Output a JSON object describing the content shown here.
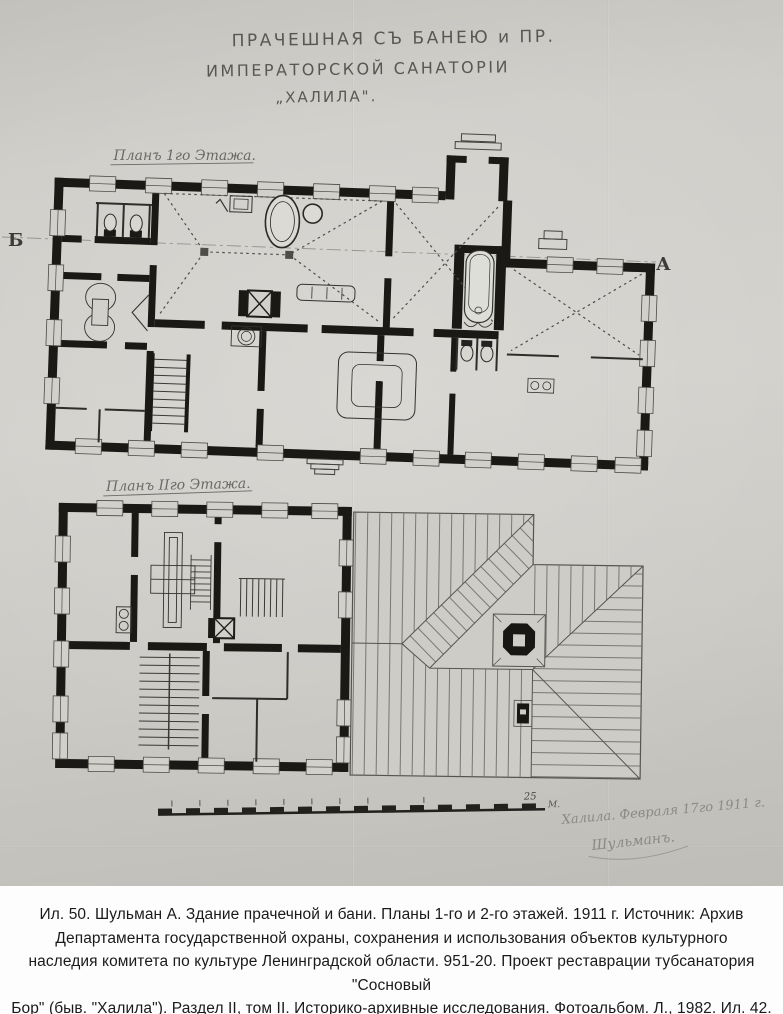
{
  "photo": {
    "title_lines": [
      "ПРАЧЕШНАЯ СЪ БАНЕЮ и ПР.",
      "ИМПЕРАТОРСКОЙ САНАТОРІИ",
      "„ХАЛИЛА\"."
    ],
    "plan1_label": "Планъ 1го Этажа.",
    "plan2_label": "Планъ IIго Этажа.",
    "section_letter_left": "Б",
    "section_letter_right": "А",
    "scale_number": "25",
    "scale_unit": "М.",
    "handwritten_date": "Халила. Февраля 17го 1911 г.",
    "handwritten_signature": "Шульманъ.",
    "colors": {
      "paper": "#cdcbc6",
      "ink": "#1a1915",
      "pencil": "#6e6c67"
    }
  },
  "caption": {
    "lines": [
      "Ил. 50. Шульман А. Здание прачечной и бани. Планы 1-го и 2-го этажей. 1911 г. Источник: Архив",
      "Департамента государственной охраны, сохранения и использования объектов культурного",
      "наследия комитета по культуре Ленинградской области. 951-20. Проект реставрации тубсанатория \"Сосновый",
      "Бор\" (быв. \"Халила\"). Раздел II, том II. Историко-архивные исследования. Фотоальбом. Л., 1982. Ил. 42."
    ]
  }
}
